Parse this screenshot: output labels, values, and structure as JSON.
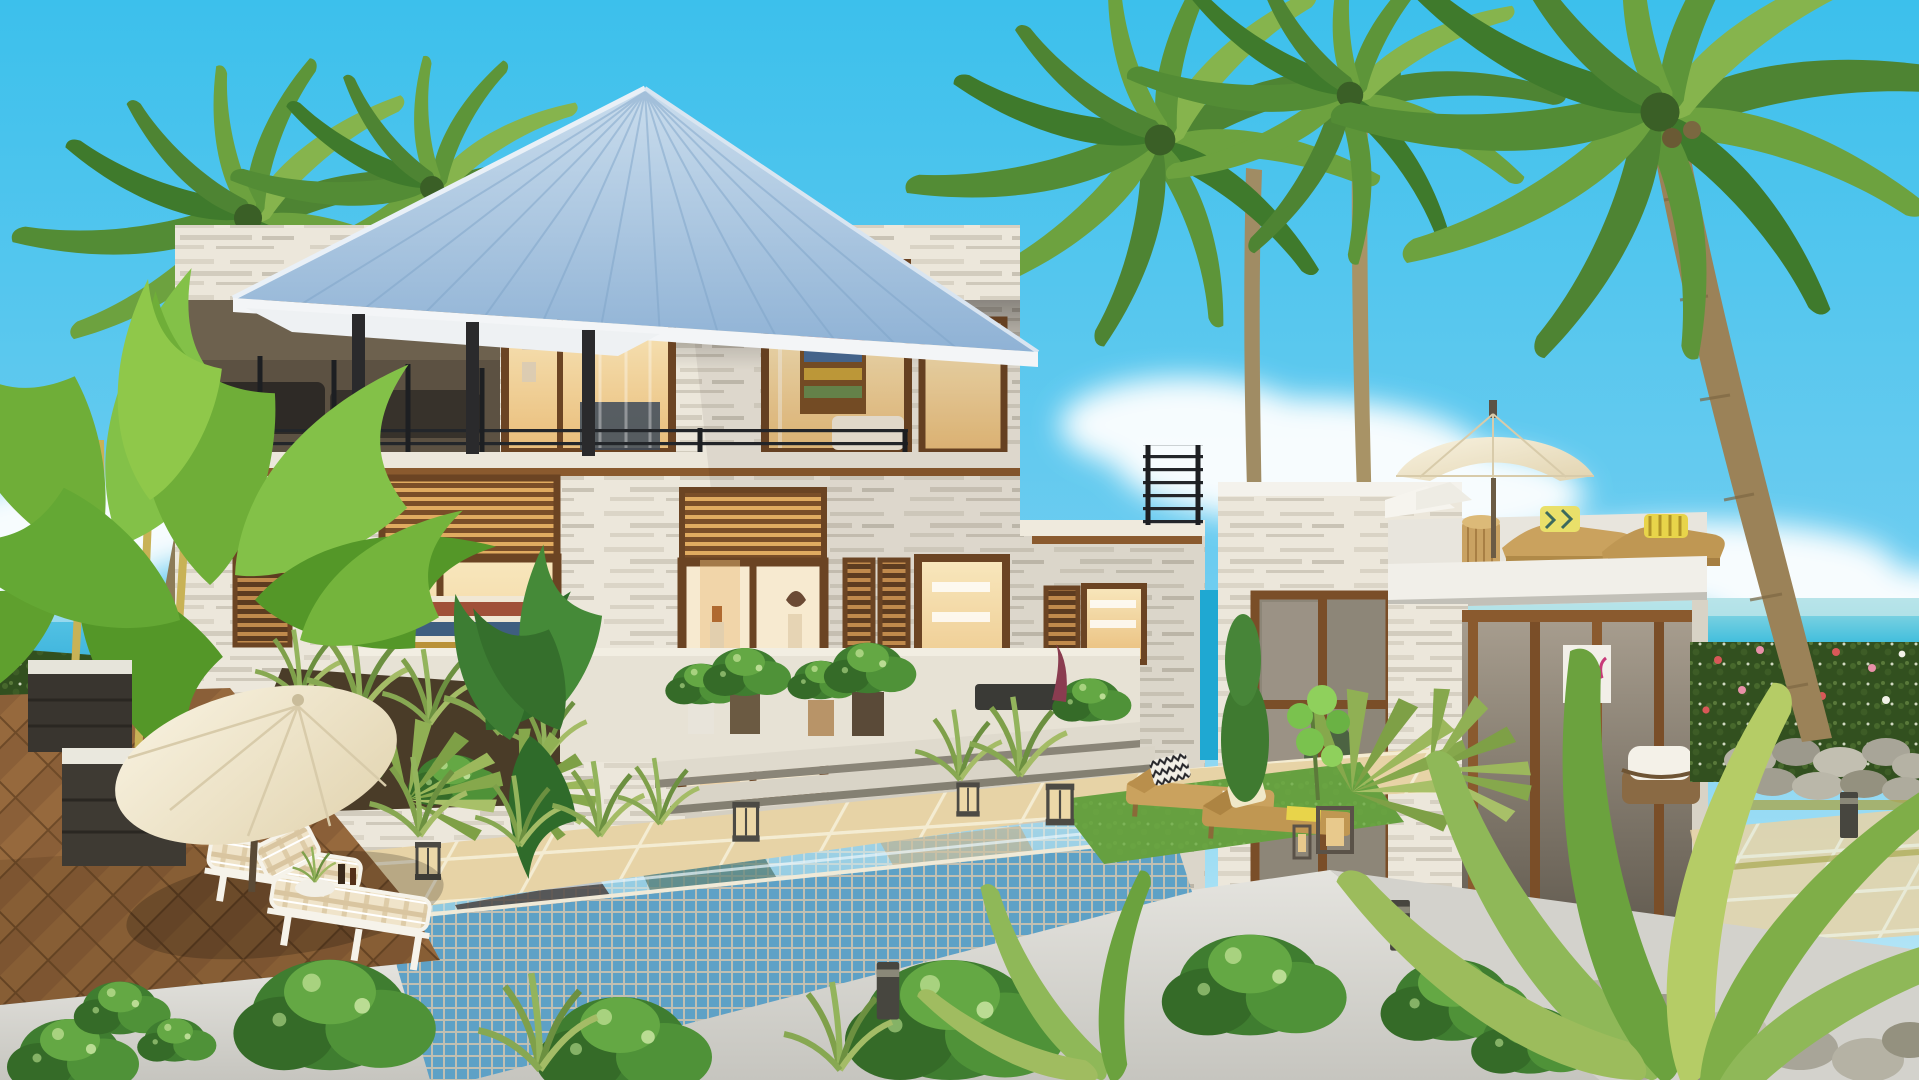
{
  "scene": {
    "title": "Tropical two-storey villa with infinity pool, wooden deck and ocean view at golden hour",
    "type": "3d-architectural-rendering",
    "setting": "seaside hillside estate surrounded by palm trees",
    "weather": "clear blue sky with scattered cumulus clouds"
  },
  "palette": {
    "sky_top": "#3cc0ec",
    "sky_horizon": "#c9ecf8",
    "cloud_white": "#ffffff",
    "ocean_deep": "#0ca5d1",
    "ocean_light": "#9adce4",
    "roof_light": "#cadded",
    "roof_shade": "#8fb2d5",
    "fascia_white": "#f3f5f7",
    "wall_light": "#ece7db",
    "wall_streak": "#d2ccbe",
    "wood_dark": "#5d3c20",
    "wood_mid": "#8a5a2e",
    "louvre_slat": "#c08a4c",
    "interior_glow": "#f8e7bd",
    "interior_warm": "#e9bd79",
    "railing_dark": "#23262a",
    "pool_tile": "#68b0d6",
    "pool_grout": "#d9d2c0",
    "pool_water": "#a6d4e6",
    "paver_tan": "#e7d3a6",
    "paver_grout": "#f4ecd2",
    "deck_brown": "#8a5f38",
    "deck_gap": "#6e4a28",
    "concrete_white": "#dcdbd5",
    "umbrella_cream": "#f4ecd6",
    "cushion_plaid": "#f0e4ca",
    "rattan_tan": "#caa25e",
    "foliage_dark": "#3f7a2c",
    "foliage_mid": "#5d9539",
    "foliage_light": "#86b44d",
    "banana_green": "#6fae38",
    "trunk_grey": "#9b8258",
    "trunk_gold": "#c8b256",
    "hedge_dark": "#32501f",
    "flower_red": "#d85858",
    "flower_pink": "#e890a8",
    "stone_grey": "#aaa79a"
  },
  "elements": {
    "sky": {
      "label": "clear tropical sky",
      "clouds": "white cumulus low over horizon"
    },
    "ocean": {
      "label": "turquoise sea visible left of deck and right of annex",
      "horizon": "hazy light band"
    },
    "main_house": {
      "label": "two-storey villa",
      "roof": "pale blue standing-seam metal hip roof with deep eaves",
      "walls": "white travertine stone strips",
      "upper_floor": "open veranda with black railing and dark lounge furniture, two warm-lit bedrooms, louvred transoms",
      "lower_floor": "library window with bookshelves, glass entry doors with lit gallery interior, louvred shutters",
      "terrace": "stone terrace with potted plants and wide steps down to the pool deck"
    },
    "annex": {
      "label": "white cubic pool house",
      "rooftop": "roof terrace with cream patio umbrella, two rattan sun loungers, patterned pillows and rattan drum side table",
      "front": "floor-to-ceiling wood-mullioned windows, shaded patio with white wicker armchair and pink abstract artwork"
    },
    "pool": {
      "label": "infinity edge pool",
      "finish": "light blue mosaic tile with cream grout",
      "lights": "four cube lanterns along the coping"
    },
    "deck": {
      "label": "herringbone hardwood sun deck",
      "furniture": "two white loungers with plaid cushions, cream tilted umbrella, planter boxes with white pebbles and golden-stem palms"
    },
    "gardens": {
      "label": "tropical landscaping",
      "left": "banana plants and flowering hedge",
      "center": "monstera, grasses and potted shrubs around the terrace",
      "right": "flowering hedge, dry-stone retaining walls, mossy path, bollard lights, leaning coconut palm",
      "foreground": "green shrubs and areca fronds along the lower white wall"
    },
    "lighting": {
      "label": "warm interior lighting throughout, late afternoon sun from the left"
    }
  }
}
